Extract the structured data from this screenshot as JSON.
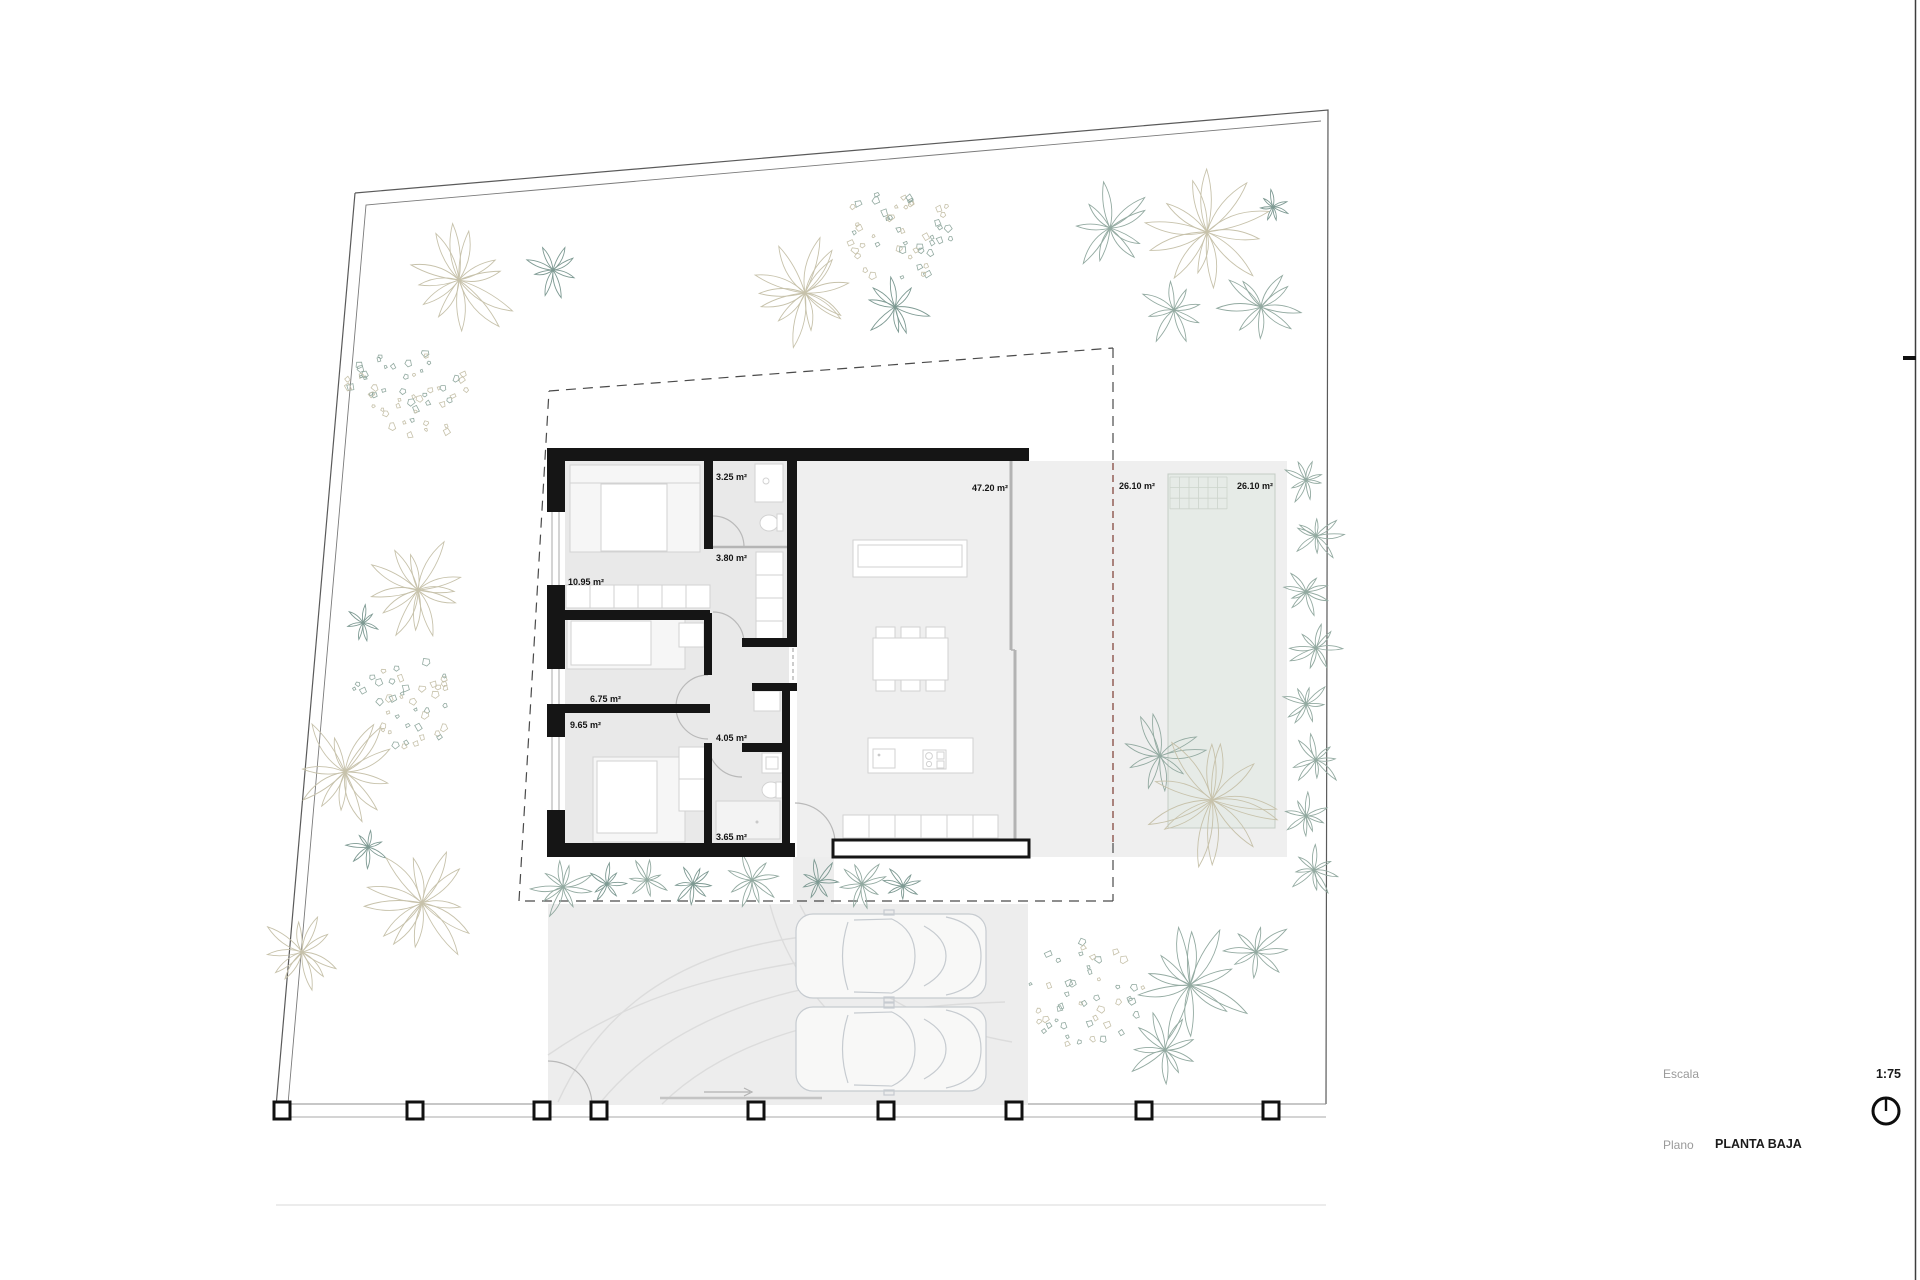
{
  "plan": {
    "rooms": [
      {
        "name": "bedroom-1",
        "area": "10.95 m²"
      },
      {
        "name": "bathroom-1",
        "area": "3.25 m²"
      },
      {
        "name": "hall",
        "area": "3.80 m²"
      },
      {
        "name": "dressing",
        "area": "6.75 m²"
      },
      {
        "name": "bedroom-2",
        "area": "9.65 m²"
      },
      {
        "name": "bathroom-2",
        "area": "4.05 m²"
      },
      {
        "name": "bathroom-3",
        "area": "3.65 m²"
      },
      {
        "name": "living-kitchen",
        "area": "47.20 m²"
      },
      {
        "name": "terrace",
        "area": "26.10 m²"
      },
      {
        "name": "pool",
        "area": "26.10 m²"
      }
    ]
  },
  "title_block": {
    "escala_label": "Escala",
    "escala_value": "1:75",
    "plano_label": "Plano",
    "plano_value": "PLANTA BAJA"
  },
  "colors": {
    "wall": "#151515",
    "room_fill": "#e9e9e9",
    "terrace_fill": "#efefef",
    "driveway_fill": "#ededed",
    "pool_fill": "#e6ebe7",
    "furniture_stroke": "#d2d2d2",
    "boundary": "#5a5a5a",
    "setback_dash": "#4a4a4a",
    "pool_dash": "#8c544c",
    "vegetation_green": "#93aaa1",
    "vegetation_dark_green": "#7e9a93",
    "vegetation_beige": "#c7c2ab",
    "car_stroke": "#c6cbd0",
    "door_arc": "#b9b9b9"
  }
}
